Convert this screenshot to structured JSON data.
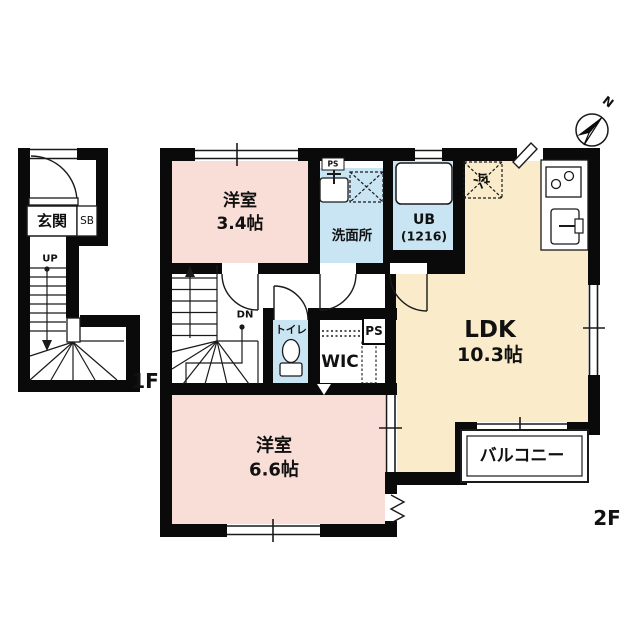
{
  "meta": {
    "kind": "japanese-floor-plan"
  },
  "colors": {
    "wall": "#0a0a0a",
    "room_pink": "#f8ded6",
    "room_blue": "#c9e4f3",
    "room_cream": "#faecca",
    "line": "#1a1a1a"
  },
  "first_floor": {
    "label": "1F",
    "entrance": "玄関",
    "shoe_box": "SB",
    "stairs_up": "UP"
  },
  "second_floor": {
    "label": "2F",
    "stairs_down": "DN",
    "rooms": [
      {
        "name": "洋室",
        "size": "3.4帖"
      },
      {
        "name": "洗面所"
      },
      {
        "name": "UB",
        "size": "(1216)"
      },
      {
        "name": "LDK",
        "size": "10.3帖"
      },
      {
        "name": "トイレ"
      },
      {
        "name": "WIC"
      },
      {
        "name": "洋室",
        "size": "6.6帖"
      },
      {
        "name": "バルコニー"
      }
    ],
    "fixtures": {
      "refrigerator": "冷",
      "pipe_space_top": "PS",
      "pipe_space": "PS"
    }
  },
  "compass": {
    "north": "N"
  }
}
